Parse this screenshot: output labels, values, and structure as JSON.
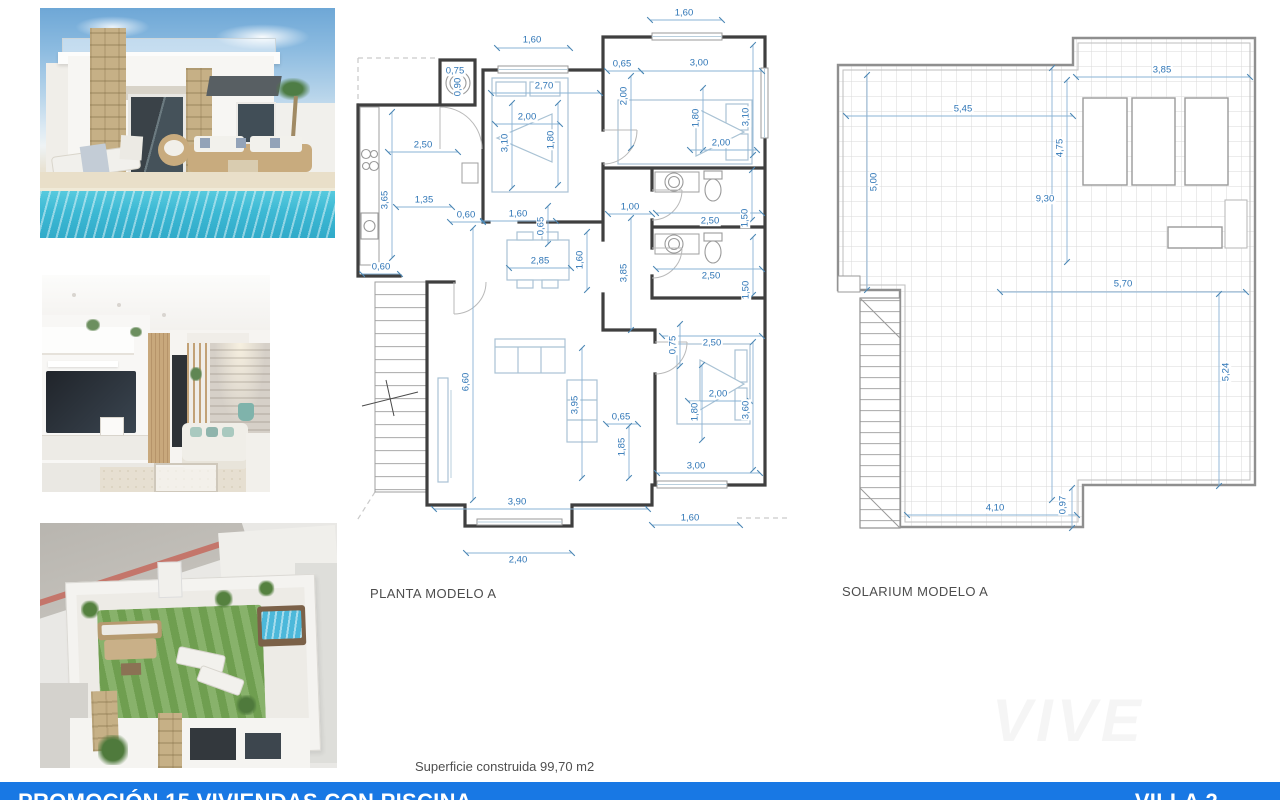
{
  "footer": {
    "title": "PROMOCIÓN 15 VIVIENDAS CON PISCINA",
    "villa_label": "VILLA 2",
    "bar_color": "#1878e4"
  },
  "watermark": "VIVE",
  "colors": {
    "dim_text": "#2e75b6",
    "dim_line": "#8ab3d5",
    "dim_tick": "#4a86b4",
    "wall": "#3f3f3f"
  },
  "plans": {
    "planta": {
      "title": "PLANTA MODELO A",
      "superficie": "Superficie construida 99,70 m2",
      "dims": [
        {
          "t": "1,60",
          "x": 532,
          "y": 40,
          "r": 0,
          "l": [
            497,
            48,
            570,
            48
          ]
        },
        {
          "t": "2,70",
          "x": 544,
          "y": 86,
          "r": 0,
          "l": [
            491,
            93,
            600,
            93
          ]
        },
        {
          "t": "2,00",
          "x": 527,
          "y": 117,
          "r": 0,
          "l": [
            495,
            124,
            560,
            124
          ]
        },
        {
          "t": "3,10",
          "x": 505,
          "y": 143,
          "r": -90,
          "l": [
            512,
            103,
            512,
            188
          ]
        },
        {
          "t": "1,80",
          "x": 551,
          "y": 140,
          "r": -90,
          "l": [
            558,
            103,
            558,
            185
          ]
        },
        {
          "t": "0,75",
          "x": 455,
          "y": 71,
          "r": 0
        },
        {
          "t": "0,90",
          "x": 458,
          "y": 87,
          "r": -90
        },
        {
          "t": "1,60",
          "x": 684,
          "y": 13,
          "r": 0,
          "l": [
            650,
            20,
            722,
            20
          ]
        },
        {
          "t": "0,65",
          "x": 622,
          "y": 64,
          "r": 0,
          "l": [
            607,
            71,
            641,
            71
          ]
        },
        {
          "t": "3,00",
          "x": 699,
          "y": 63,
          "r": 0,
          "l": [
            641,
            71,
            762,
            71
          ]
        },
        {
          "t": "2,00",
          "x": 624,
          "y": 96,
          "r": -90,
          "l": [
            631,
            76,
            631,
            148
          ]
        },
        {
          "t": "1,80",
          "x": 696,
          "y": 118,
          "r": -90,
          "l": [
            703,
            88,
            703,
            150
          ]
        },
        {
          "t": "3,10",
          "x": 746,
          "y": 117,
          "r": -90,
          "l": [
            753,
            45,
            753,
            155
          ]
        },
        {
          "t": "2,00",
          "x": 721,
          "y": 143,
          "r": 0,
          "l": [
            690,
            150,
            757,
            150
          ]
        },
        {
          "t": "2,50",
          "x": 423,
          "y": 145,
          "r": 0,
          "l": [
            388,
            152,
            458,
            152
          ]
        },
        {
          "t": "3,65",
          "x": 385,
          "y": 200,
          "r": -90,
          "l": [
            392,
            112,
            392,
            258
          ]
        },
        {
          "t": "1,35",
          "x": 424,
          "y": 200,
          "r": 0,
          "l": [
            396,
            207,
            452,
            207
          ]
        },
        {
          "t": "0,60",
          "x": 466,
          "y": 215,
          "r": 0,
          "l": [
            450,
            222,
            483,
            222
          ]
        },
        {
          "t": "1,60",
          "x": 518,
          "y": 214,
          "r": 0,
          "l": [
            483,
            221,
            556,
            221
          ]
        },
        {
          "t": "0,65",
          "x": 541,
          "y": 226,
          "r": -90,
          "l": [
            548,
            206,
            548,
            244
          ]
        },
        {
          "t": "0,60",
          "x": 381,
          "y": 267,
          "r": 0,
          "l": [
            362,
            274,
            400,
            274
          ]
        },
        {
          "t": "1,00",
          "x": 630,
          "y": 207,
          "r": 0,
          "l": [
            608,
            214,
            652,
            214
          ]
        },
        {
          "t": "3,85",
          "x": 624,
          "y": 273,
          "r": -90,
          "l": [
            631,
            218,
            631,
            330
          ]
        },
        {
          "t": "2,85",
          "x": 540,
          "y": 261,
          "r": 0,
          "l": [
            509,
            268,
            571,
            268
          ]
        },
        {
          "t": "1,60",
          "x": 580,
          "y": 260,
          "r": -90,
          "l": [
            587,
            232,
            587,
            290
          ]
        },
        {
          "t": "2,50",
          "x": 710,
          "y": 221,
          "r": 0,
          "l": [
            656,
            213,
            762,
            213
          ]
        },
        {
          "t": "1,50",
          "x": 745,
          "y": 218,
          "r": -90,
          "l": [
            752,
            170,
            752,
            220
          ]
        },
        {
          "t": "2,50",
          "x": 711,
          "y": 276,
          "r": 0,
          "l": [
            656,
            269,
            762,
            269
          ]
        },
        {
          "t": "1,50",
          "x": 746,
          "y": 290,
          "r": -90,
          "l": [
            753,
            237,
            753,
            295
          ]
        },
        {
          "t": "0,75",
          "x": 673,
          "y": 345,
          "r": -90,
          "l": [
            680,
            324,
            680,
            366
          ]
        },
        {
          "t": "2,50",
          "x": 712,
          "y": 343,
          "r": 0,
          "l": [
            662,
            336,
            762,
            336
          ]
        },
        {
          "t": "2,00",
          "x": 718,
          "y": 394,
          "r": 0,
          "l": [
            688,
            401,
            750,
            401
          ]
        },
        {
          "t": "1,80",
          "x": 695,
          "y": 412,
          "r": -90,
          "l": [
            702,
            365,
            702,
            440
          ]
        },
        {
          "t": "3,60",
          "x": 746,
          "y": 410,
          "r": -90,
          "l": [
            753,
            342,
            753,
            470
          ]
        },
        {
          "t": "3,00",
          "x": 696,
          "y": 466,
          "r": 0,
          "l": [
            657,
            473,
            760,
            473
          ]
        },
        {
          "t": "0,65",
          "x": 621,
          "y": 417,
          "r": 0,
          "l": [
            606,
            424,
            638,
            424
          ]
        },
        {
          "t": "1,85",
          "x": 622,
          "y": 447,
          "r": -90,
          "l": [
            629,
            426,
            629,
            478
          ]
        },
        {
          "t": "3,95",
          "x": 575,
          "y": 405,
          "r": -90,
          "l": [
            582,
            348,
            582,
            478
          ]
        },
        {
          "t": "6,60",
          "x": 466,
          "y": 382,
          "r": -90,
          "l": [
            473,
            228,
            473,
            500
          ]
        },
        {
          "t": "3,90",
          "x": 517,
          "y": 502,
          "r": 0,
          "l": [
            434,
            509,
            648,
            509
          ]
        },
        {
          "t": "1,60",
          "x": 690,
          "y": 518,
          "r": 0,
          "l": [
            652,
            525,
            740,
            525
          ]
        },
        {
          "t": "2,40",
          "x": 518,
          "y": 560,
          "r": 0,
          "l": [
            466,
            553,
            572,
            553
          ]
        }
      ]
    },
    "solarium": {
      "title": "SOLARIUM MODELO A",
      "dims": [
        {
          "t": "3,85",
          "x": 1162,
          "y": 70,
          "r": 0,
          "l": [
            1076,
            77,
            1250,
            77
          ]
        },
        {
          "t": "5,45",
          "x": 963,
          "y": 109,
          "r": 0,
          "l": [
            846,
            116,
            1073,
            116
          ]
        },
        {
          "t": "4,75",
          "x": 1060,
          "y": 148,
          "r": -90,
          "l": [
            1067,
            80,
            1067,
            262
          ]
        },
        {
          "t": "5,00",
          "x": 874,
          "y": 182,
          "r": -90,
          "l": [
            867,
            75,
            867,
            290
          ]
        },
        {
          "t": "9,30",
          "x": 1045,
          "y": 199,
          "r": 0,
          "l": [
            1052,
            68,
            1052,
            500
          ]
        },
        {
          "t": "5,70",
          "x": 1123,
          "y": 284,
          "r": 0,
          "l": [
            1000,
            292,
            1246,
            292
          ]
        },
        {
          "t": "5,24",
          "x": 1226,
          "y": 372,
          "r": -90,
          "l": [
            1219,
            294,
            1219,
            486
          ]
        },
        {
          "t": "4,10",
          "x": 995,
          "y": 508,
          "r": 0,
          "l": [
            907,
            515,
            1077,
            515
          ]
        },
        {
          "t": "0,97",
          "x": 1063,
          "y": 505,
          "r": -90,
          "l": [
            1072,
            488,
            1072,
            528
          ]
        }
      ]
    }
  }
}
